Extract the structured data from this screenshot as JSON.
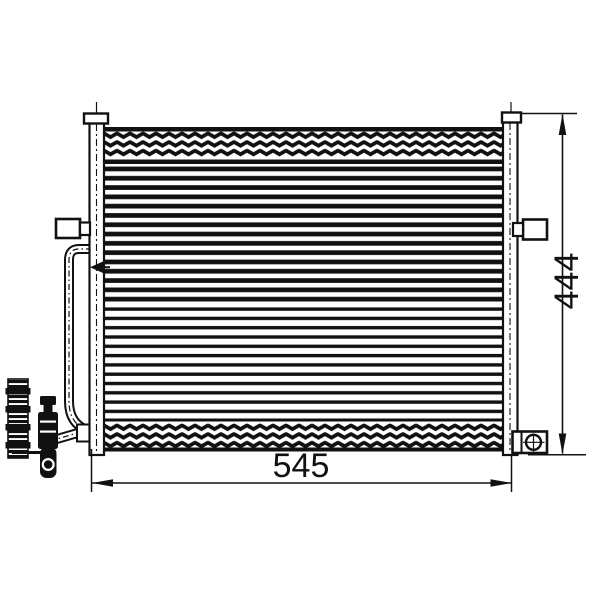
{
  "drawing": {
    "type": "technical-line-drawing",
    "subject": "automotive condenser front view",
    "dimensions": {
      "width_label": "545",
      "height_label": "444"
    },
    "colors": {
      "line": "#111111",
      "background": "#ffffff"
    },
    "components": [
      "core-with-fin-bands",
      "left-header-tube",
      "right-header-tube",
      "left-header-cap",
      "right-header-cap",
      "left-mounting-bracket",
      "right-mounting-bracket",
      "bottom-right-mounting-bracket-with-bolt-hole",
      "inlet-pipe",
      "outlet-pipe",
      "pressure-switch-fitting",
      "receiver-drier-fitting"
    ]
  }
}
